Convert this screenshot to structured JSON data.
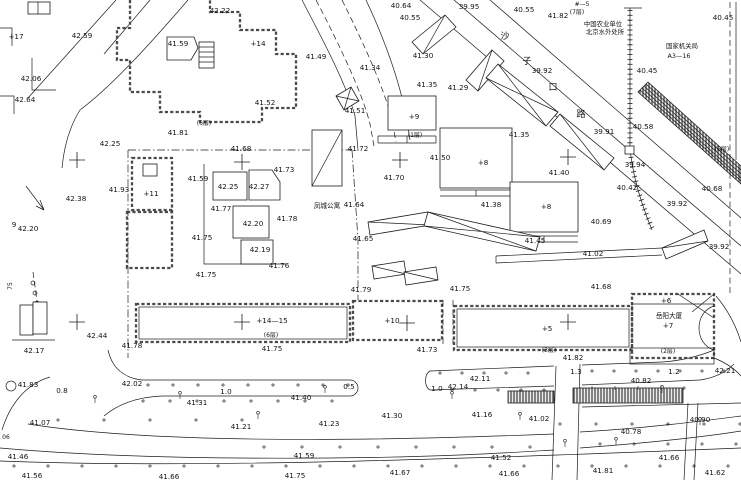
{
  "canvas": {
    "width": 741,
    "height": 480
  },
  "colors": {
    "paper": "#ffffff",
    "ink": "#1c1c1c",
    "wall_gray": "#4a4a4a",
    "hatch_gray": "#555555"
  },
  "kind_names": {
    "elev": "elevation-label",
    "bnum": "building-number-label",
    "floors": "floor-count-label",
    "name": "building-name-label",
    "org": "org-name-label",
    "street": "street-name-char",
    "dim": "dimension-label",
    "misc": "annotation-label"
  },
  "labels": [
    {
      "t": "42.22",
      "x": 220,
      "y": 13
    },
    {
      "t": "∔17",
      "x": 16,
      "y": 39,
      "k": "bnum"
    },
    {
      "t": "42.59",
      "x": 82,
      "y": 38
    },
    {
      "t": "41.59",
      "x": 178,
      "y": 46
    },
    {
      "t": "∔14",
      "x": 258,
      "y": 46,
      "k": "bnum"
    },
    {
      "t": "40.64",
      "x": 401,
      "y": 8
    },
    {
      "t": "40.55",
      "x": 410,
      "y": 20
    },
    {
      "t": "39.95",
      "x": 469,
      "y": 9
    },
    {
      "t": "40.55",
      "x": 524,
      "y": 12
    },
    {
      "t": "41.82",
      "x": 558,
      "y": 18
    },
    {
      "t": "#—5",
      "x": 582,
      "y": 6,
      "k": "misc",
      "fs": 6
    },
    {
      "t": "(7层)",
      "x": 577,
      "y": 14,
      "k": "floors",
      "fs": 6
    },
    {
      "t": "中国农业单位",
      "x": 603,
      "y": 26,
      "k": "org",
      "fs": 6.4
    },
    {
      "t": "北京水外处所",
      "x": 605,
      "y": 34,
      "k": "org",
      "fs": 6.4
    },
    {
      "t": "国家机关局",
      "x": 682,
      "y": 48,
      "k": "org",
      "fs": 6.4
    },
    {
      "t": "A3—16",
      "x": 679,
      "y": 58,
      "k": "org",
      "fs": 6.4
    },
    {
      "t": "40.45",
      "x": 723,
      "y": 20
    },
    {
      "t": "42.06",
      "x": 31,
      "y": 81
    },
    {
      "t": "42.64",
      "x": 25,
      "y": 102
    },
    {
      "t": "41.52",
      "x": 265,
      "y": 105
    },
    {
      "t": "41.49",
      "x": 316,
      "y": 59
    },
    {
      "t": "41.51",
      "x": 355,
      "y": 113
    },
    {
      "t": "41.34",
      "x": 370,
      "y": 70
    },
    {
      "t": "41.30",
      "x": 423,
      "y": 58
    },
    {
      "t": "41.35",
      "x": 427,
      "y": 87
    },
    {
      "t": "41.29",
      "x": 458,
      "y": 90
    },
    {
      "t": "39.92",
      "x": 542,
      "y": 73
    },
    {
      "t": "40.45",
      "x": 647,
      "y": 73
    },
    {
      "t": "沙",
      "x": 505,
      "y": 39,
      "k": "street",
      "fs": 9
    },
    {
      "t": "子",
      "x": 527,
      "y": 64,
      "k": "street",
      "fs": 9
    },
    {
      "t": "口",
      "x": 553,
      "y": 90,
      "k": "street",
      "fs": 9
    },
    {
      "t": "路",
      "x": 581,
      "y": 117,
      "k": "street",
      "fs": 9
    },
    {
      "t": "39.91",
      "x": 604,
      "y": 134
    },
    {
      "t": "40.58",
      "x": 643,
      "y": 129
    },
    {
      "t": "(5层)",
      "x": 722,
      "y": 151,
      "k": "floors",
      "fs": 6
    },
    {
      "t": "39.94",
      "x": 635,
      "y": 167
    },
    {
      "t": "40.42",
      "x": 627,
      "y": 190
    },
    {
      "t": "39.92",
      "x": 677,
      "y": 206
    },
    {
      "t": "40.68",
      "x": 712,
      "y": 191
    },
    {
      "t": "39.92",
      "x": 719,
      "y": 249
    },
    {
      "t": "42.25",
      "x": 110,
      "y": 146
    },
    {
      "t": "(6层)",
      "x": 204,
      "y": 125,
      "k": "floors",
      "fs": 6
    },
    {
      "t": "41.81",
      "x": 178,
      "y": 135
    },
    {
      "t": "41.68",
      "x": 241,
      "y": 151
    },
    {
      "t": "41.72",
      "x": 358,
      "y": 151
    },
    {
      "t": "41.73",
      "x": 284,
      "y": 172
    },
    {
      "t": "41.59",
      "x": 198,
      "y": 181
    },
    {
      "t": "∔11",
      "x": 151,
      "y": 196,
      "k": "bnum"
    },
    {
      "t": "41.93",
      "x": 119,
      "y": 192
    },
    {
      "t": "42.38",
      "x": 76,
      "y": 201
    },
    {
      "t": "9",
      "x": 14,
      "y": 227,
      "k": "misc"
    },
    {
      "t": "42.20",
      "x": 28,
      "y": 231
    },
    {
      "t": "42.25",
      "x": 228,
      "y": 189
    },
    {
      "t": "42.27",
      "x": 259,
      "y": 189
    },
    {
      "t": "41.77",
      "x": 221,
      "y": 211
    },
    {
      "t": "42.20",
      "x": 253,
      "y": 226
    },
    {
      "t": "41.78",
      "x": 287,
      "y": 221
    },
    {
      "t": "41.75",
      "x": 202,
      "y": 240
    },
    {
      "t": "42.19",
      "x": 260,
      "y": 252
    },
    {
      "t": "41.76",
      "x": 279,
      "y": 268
    },
    {
      "t": "凤城公寓",
      "x": 327,
      "y": 208,
      "k": "name",
      "fs": 6.6
    },
    {
      "t": "41.64",
      "x": 354,
      "y": 207
    },
    {
      "t": "41.65",
      "x": 363,
      "y": 241
    },
    {
      "t": "41.70",
      "x": 394,
      "y": 180
    },
    {
      "t": "41.50",
      "x": 440,
      "y": 160
    },
    {
      "t": "∔9",
      "x": 414,
      "y": 119,
      "k": "bnum"
    },
    {
      "t": "(1层)",
      "x": 415,
      "y": 137,
      "k": "floors",
      "fs": 6
    },
    {
      "t": "∔8",
      "x": 483,
      "y": 165,
      "k": "bnum"
    },
    {
      "t": "41.35",
      "x": 519,
      "y": 137
    },
    {
      "t": "41.38",
      "x": 491,
      "y": 207
    },
    {
      "t": "∔8",
      "x": 546,
      "y": 209,
      "k": "bnum"
    },
    {
      "t": "41.40",
      "x": 559,
      "y": 175
    },
    {
      "t": "41.45",
      "x": 535,
      "y": 243
    },
    {
      "t": "40.69",
      "x": 601,
      "y": 224
    },
    {
      "t": "41.02",
      "x": 593,
      "y": 256
    },
    {
      "t": "41.68",
      "x": 601,
      "y": 289
    },
    {
      "t": "41.79",
      "x": 361,
      "y": 292
    },
    {
      "t": "41.75",
      "x": 460,
      "y": 291
    },
    {
      "t": "75",
      "x": 12,
      "y": 286,
      "k": "misc",
      "fs": 6,
      "r": -90
    },
    {
      "t": "41.75",
      "x": 206,
      "y": 277
    },
    {
      "t": "42.44",
      "x": 97,
      "y": 338
    },
    {
      "t": "42.17",
      "x": 34,
      "y": 353
    },
    {
      "t": "41.78",
      "x": 132,
      "y": 348
    },
    {
      "t": "∔14—15",
      "x": 272,
      "y": 323,
      "k": "bnum"
    },
    {
      "t": "(6层)",
      "x": 271,
      "y": 337,
      "k": "floors",
      "fs": 6
    },
    {
      "t": "41.75",
      "x": 272,
      "y": 351
    },
    {
      "t": "∔10",
      "x": 392,
      "y": 323,
      "k": "bnum"
    },
    {
      "t": "41.73",
      "x": 427,
      "y": 352
    },
    {
      "t": "∔5",
      "x": 547,
      "y": 331,
      "k": "bnum"
    },
    {
      "t": "(3层)",
      "x": 549,
      "y": 352,
      "k": "floors",
      "fs": 6
    },
    {
      "t": "41.82",
      "x": 573,
      "y": 360
    },
    {
      "t": "∔6",
      "x": 666,
      "y": 303,
      "k": "bnum"
    },
    {
      "t": "岳阳大厦",
      "x": 669,
      "y": 318,
      "k": "name",
      "fs": 6.6
    },
    {
      "t": "∔7",
      "x": 668,
      "y": 328,
      "k": "bnum"
    },
    {
      "t": "(2层)",
      "x": 668,
      "y": 353,
      "k": "floors",
      "fs": 6
    },
    {
      "t": "42.21",
      "x": 725,
      "y": 373
    },
    {
      "t": "1.3",
      "x": 576,
      "y": 374,
      "k": "dim"
    },
    {
      "t": "1.2",
      "x": 674,
      "y": 374,
      "k": "dim"
    },
    {
      "t": "40.82",
      "x": 641,
      "y": 383
    },
    {
      "t": "42.11",
      "x": 480,
      "y": 381
    },
    {
      "t": "42.14",
      "x": 458,
      "y": 389
    },
    {
      "t": "1.0",
      "x": 437,
      "y": 391,
      "k": "dim"
    },
    {
      "t": "0.5",
      "x": 349,
      "y": 389,
      "k": "dim"
    },
    {
      "t": "41.83",
      "x": 28,
      "y": 387
    },
    {
      "t": "42.02",
      "x": 132,
      "y": 386
    },
    {
      "t": "0.8",
      "x": 62,
      "y": 393,
      "k": "dim"
    },
    {
      "t": "1.0",
      "x": 226,
      "y": 394,
      "k": "dim"
    },
    {
      "t": "41.40",
      "x": 301,
      "y": 400
    },
    {
      "t": "41.31",
      "x": 197,
      "y": 405
    },
    {
      "t": "41.07",
      "x": 40,
      "y": 425
    },
    {
      "t": "41.21",
      "x": 241,
      "y": 429
    },
    {
      "t": "41.23",
      "x": 329,
      "y": 426
    },
    {
      "t": "41.30",
      "x": 392,
      "y": 418
    },
    {
      "t": "41.16",
      "x": 482,
      "y": 417
    },
    {
      "t": "41.02",
      "x": 539,
      "y": 421
    },
    {
      "t": "40.90",
      "x": 700,
      "y": 422
    },
    {
      "t": "40.78",
      "x": 631,
      "y": 434
    },
    {
      "t": "06",
      "x": 6,
      "y": 439,
      "k": "misc",
      "fs": 6
    },
    {
      "t": "41.46",
      "x": 18,
      "y": 459
    },
    {
      "t": "41.59",
      "x": 304,
      "y": 458
    },
    {
      "t": "41.52",
      "x": 501,
      "y": 460
    },
    {
      "t": "41.66",
      "x": 669,
      "y": 460
    },
    {
      "t": "41.56",
      "x": 32,
      "y": 478
    },
    {
      "t": "41.66",
      "x": 169,
      "y": 479
    },
    {
      "t": "41.75",
      "x": 295,
      "y": 478
    },
    {
      "t": "41.67",
      "x": 400,
      "y": 475
    },
    {
      "t": "41.66",
      "x": 509,
      "y": 476
    },
    {
      "t": "41.81",
      "x": 603,
      "y": 473
    },
    {
      "t": "41.62",
      "x": 715,
      "y": 475
    }
  ],
  "grid_crosses": [
    [
      77,
      160
    ],
    [
      242,
      162
    ],
    [
      400,
      160
    ],
    [
      568,
      157
    ],
    [
      77,
      322
    ],
    [
      242,
      322
    ],
    [
      407,
      323
    ],
    [
      568,
      322
    ]
  ]
}
